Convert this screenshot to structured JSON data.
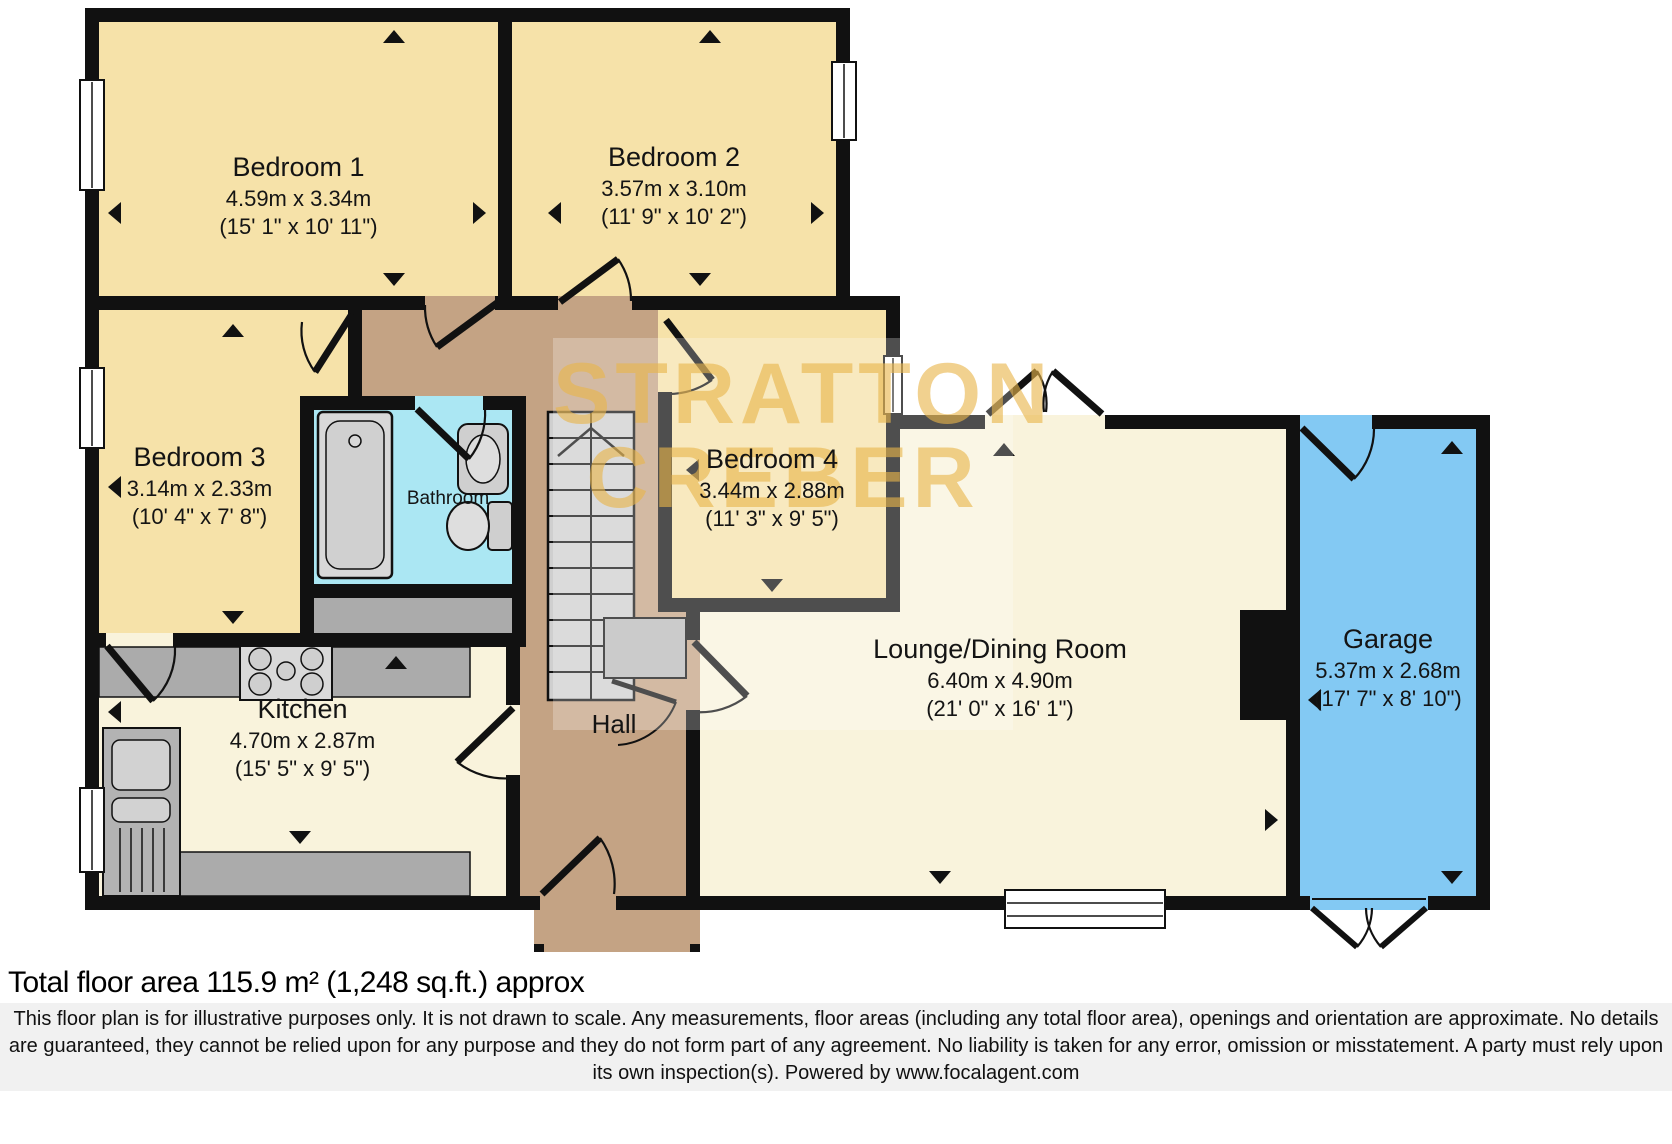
{
  "watermark": {
    "line1": "STRATTON",
    "line2": "CREBER"
  },
  "rooms": {
    "bedroom1": {
      "name": "Bedroom 1",
      "metric": "4.59m x 3.34m",
      "imperial": "(15' 1\" x 10' 11\")"
    },
    "bedroom2": {
      "name": "Bedroom 2",
      "metric": "3.57m x 3.10m",
      "imperial": "(11' 9\" x 10' 2\")"
    },
    "bedroom3": {
      "name": "Bedroom 3",
      "metric": "3.14m x 2.33m",
      "imperial": "(10' 4\" x 7' 8\")"
    },
    "bedroom4": {
      "name": "Bedroom 4",
      "metric": "3.44m x 2.88m",
      "imperial": "(11' 3\" x 9' 5\")"
    },
    "bathroom": {
      "name": "Bathroom"
    },
    "kitchen": {
      "name": "Kitchen",
      "metric": "4.70m x 2.87m",
      "imperial": "(15' 5\" x 9' 5\")"
    },
    "hall": {
      "name": "Hall"
    },
    "lounge": {
      "name": "Lounge/Dining Room",
      "metric": "6.40m x 4.90m",
      "imperial": "(21' 0\" x 16' 1\")"
    },
    "garage": {
      "name": "Garage",
      "metric": "5.37m x 2.68m",
      "imperial": "(17' 7\" x 8' 10\")"
    }
  },
  "footer": {
    "total_area": "Total floor area 115.9 m² (1,248 sq.ft.) approx",
    "disclaimer": "This floor plan is for illustrative purposes only. It is not drawn to scale. Any measurements, floor areas (including any total floor area), openings and orientation are approximate. No details are guaranteed, they cannot be relied upon for any purpose and they do not form part of any agreement. No liability is taken for any error, omission or misstatement. A party must rely upon its own inspection(s). Powered by www.focalagent.com"
  },
  "colors": {
    "bedroom_yellow": "#f6e2a9",
    "living_cream": "#f9f3dc",
    "bathroom_cyan": "#abe7f3",
    "garage_blue": "#83c9f3",
    "hall_tan": "#c4a384",
    "wall_black": "#111111",
    "counter_gray": "#ababab",
    "watermark_gold": "#e9b54a"
  }
}
